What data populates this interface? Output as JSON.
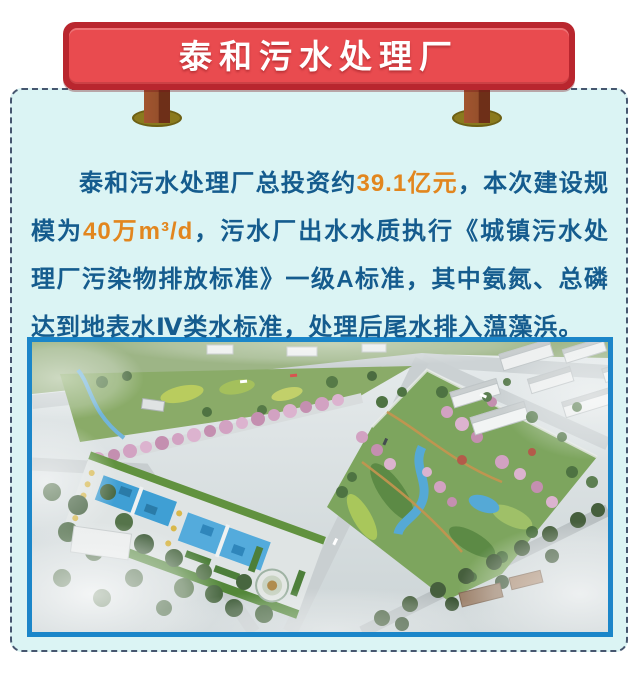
{
  "sign": {
    "title": "泰和污水处理厂"
  },
  "paragraph": {
    "segments": [
      {
        "text": "泰和污水处理厂总投资约",
        "highlight": false
      },
      {
        "text": "39.1亿元",
        "highlight": true
      },
      {
        "text": "，本次建设规模为",
        "highlight": false
      },
      {
        "text": "40万m³/d",
        "highlight": true
      },
      {
        "text": "，污水厂出水水质执行《城镇污水处理厂污染物排放标准》一级A标准，其中氨氮、总磷达到地表水Ⅳ类水标准，处理后尾水排入蕰藻浜。",
        "highlight": false
      }
    ]
  },
  "figure": {
    "name": "plant-park-aerial-rendering"
  },
  "colors": {
    "accent_red": "#e94b4f",
    "accent_red_dark": "#b9262e",
    "text_blue": "#155c8e",
    "highlight_orange": "#e2861e",
    "panel_bg": "#dbf4f4",
    "panel_border": "#46566f",
    "frame_blue": "#1b86c9",
    "post_brown": "#96502c",
    "base_olive": "#8a7a1e"
  }
}
